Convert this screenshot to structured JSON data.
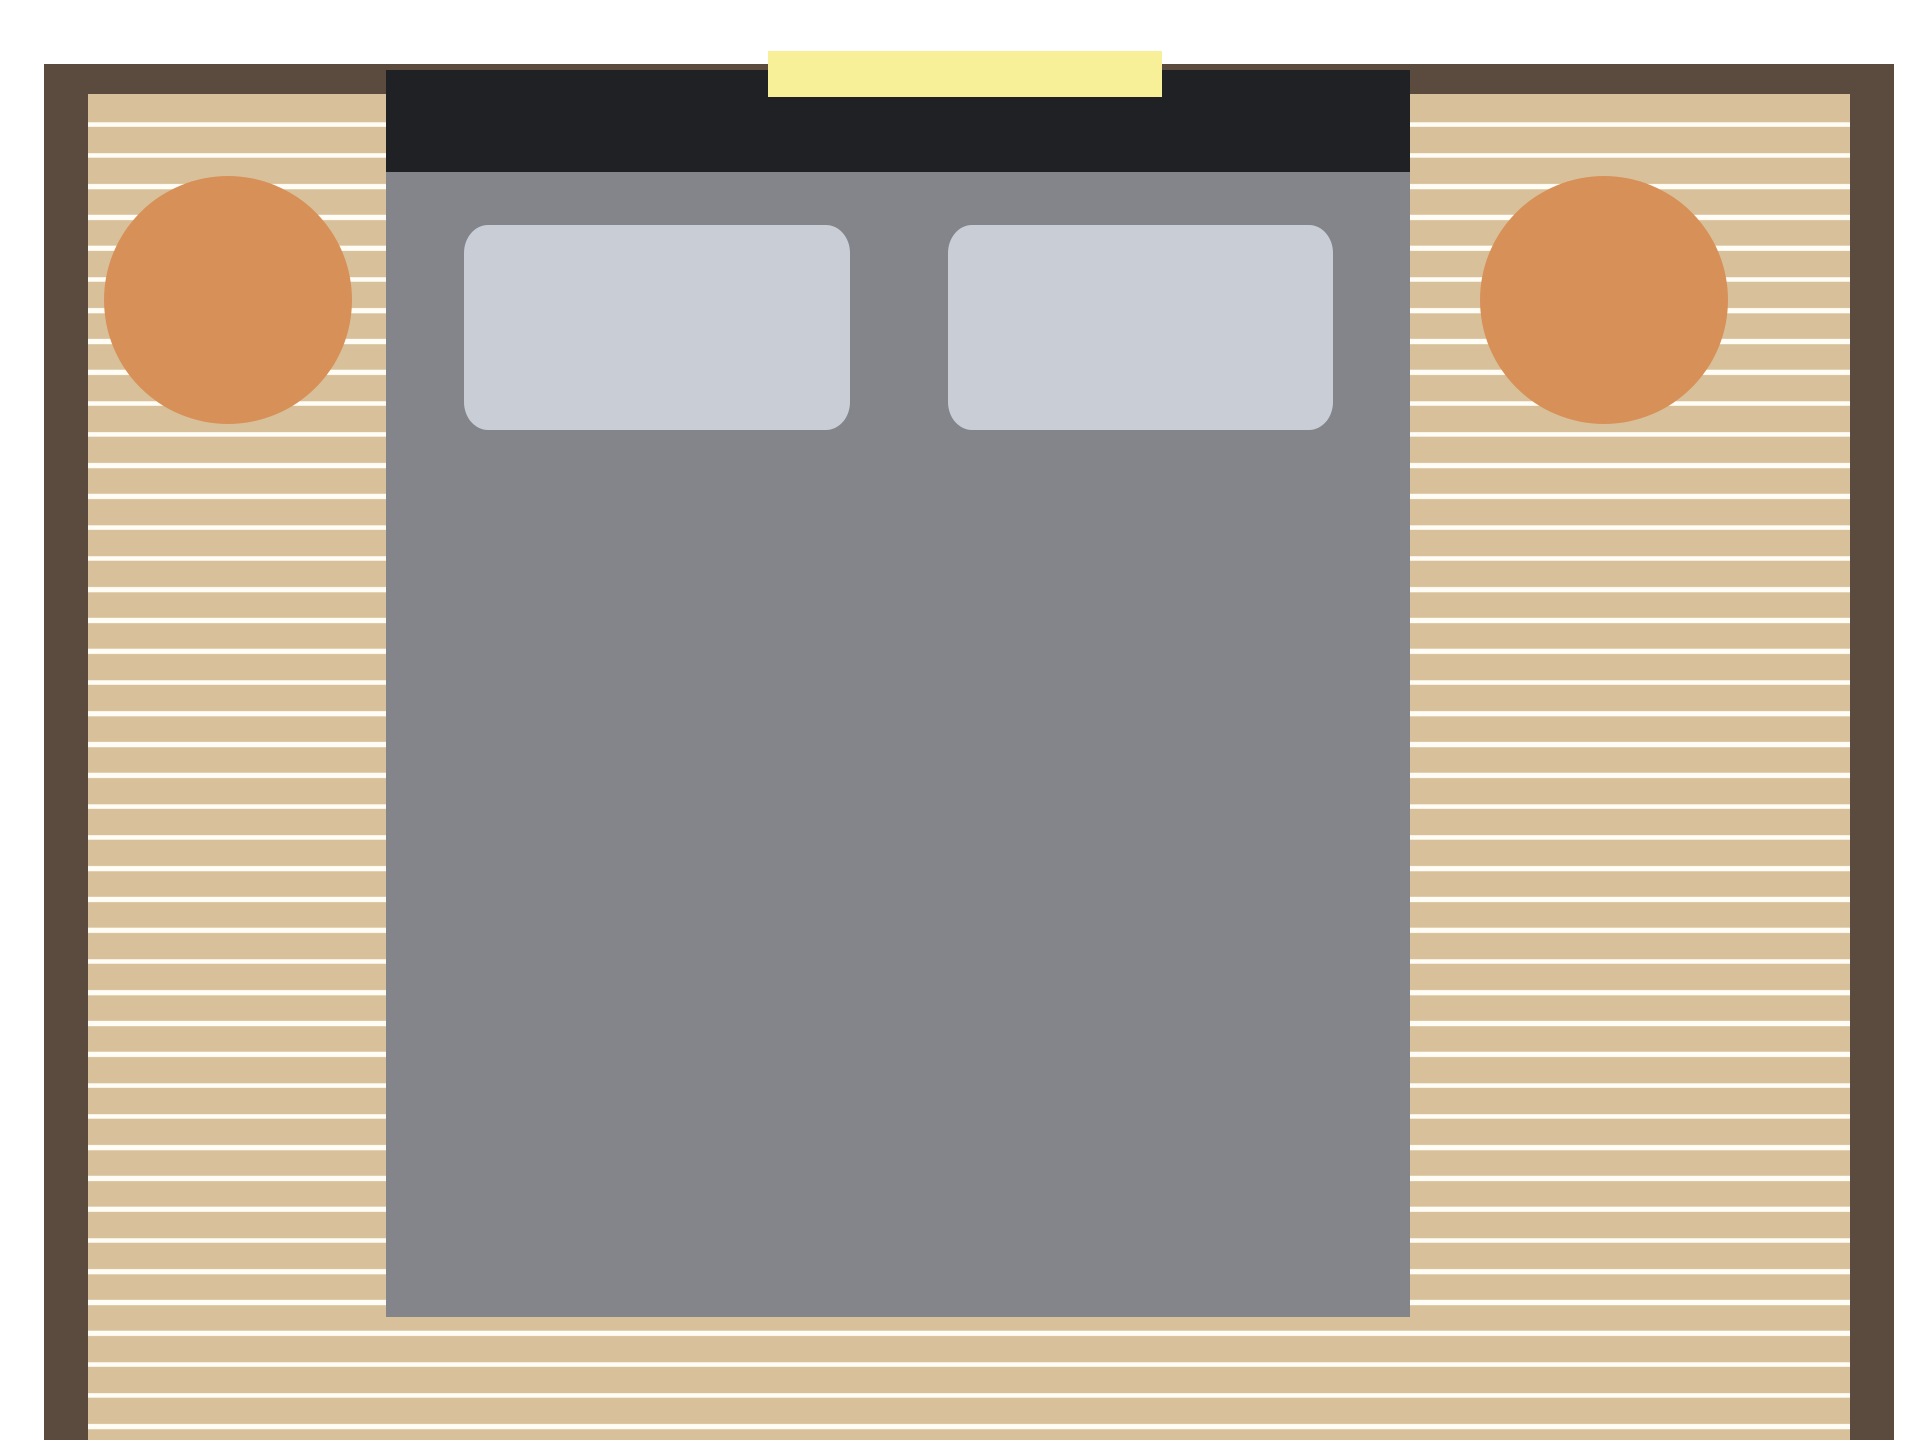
{
  "palette": {
    "bg": "#FFFFFF",
    "wall": "#5B4A3E",
    "floor-tan": "#D8C19A",
    "floor-stripe": "#FFFDF6",
    "bed": "#83858A",
    "headboard": "#202124",
    "pillow": "#C9CDD5",
    "table": "#D79158",
    "window": "#F7F098"
  },
  "scene": {
    "type": "bedroom-floor-plan",
    "elements": [
      "outer-wall",
      "striped-wood-floor",
      "window-opening",
      "headboard",
      "double-bed",
      "pillow-left",
      "pillow-right",
      "round-nightstand-left",
      "round-nightstand-right"
    ]
  }
}
